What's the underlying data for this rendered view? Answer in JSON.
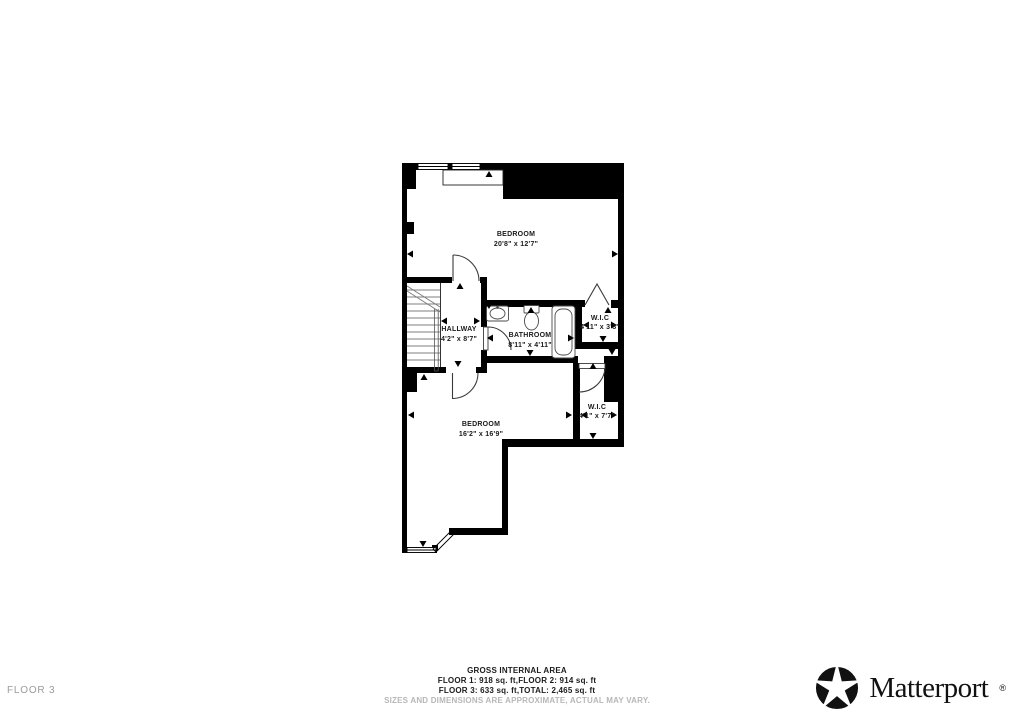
{
  "page": {
    "background": "#ffffff"
  },
  "floorplan": {
    "wall_color": "#000000",
    "line_color": "#3a3a3a",
    "rooms": [
      {
        "name": "BEDROOM",
        "dims": "20'8\" x 12'7\""
      },
      {
        "name": "HALLWAY",
        "dims": "4'2\" x 8'7\""
      },
      {
        "name": "BATHROOM",
        "dims": "8'11\" x 4'11\""
      },
      {
        "name": "W.I.C",
        "dims": "4'11\" x 3'8\""
      },
      {
        "name": "W.I.C",
        "dims": "4'1\" x 7'7\""
      },
      {
        "name": "BEDROOM",
        "dims": "16'2\" x 16'9\""
      }
    ]
  },
  "footer": {
    "title": "GROSS INTERNAL AREA",
    "line1": "FLOOR 1: 918 sq. ft,FLOOR 2: 914 sq. ft",
    "line2": "FLOOR 3: 633 sq. ft,TOTAL: 2,465 sq. ft",
    "disclaimer": "SIZES AND DIMENSIONS ARE APPROXIMATE, ACTUAL MAY VARY.",
    "disclaimer_color": "#b7b7b7"
  },
  "floor_label": {
    "text": "FLOOR 3",
    "color": "#9b9b9b"
  },
  "brand": {
    "name": "Matterport",
    "trademark": "®",
    "color": "#111111"
  }
}
